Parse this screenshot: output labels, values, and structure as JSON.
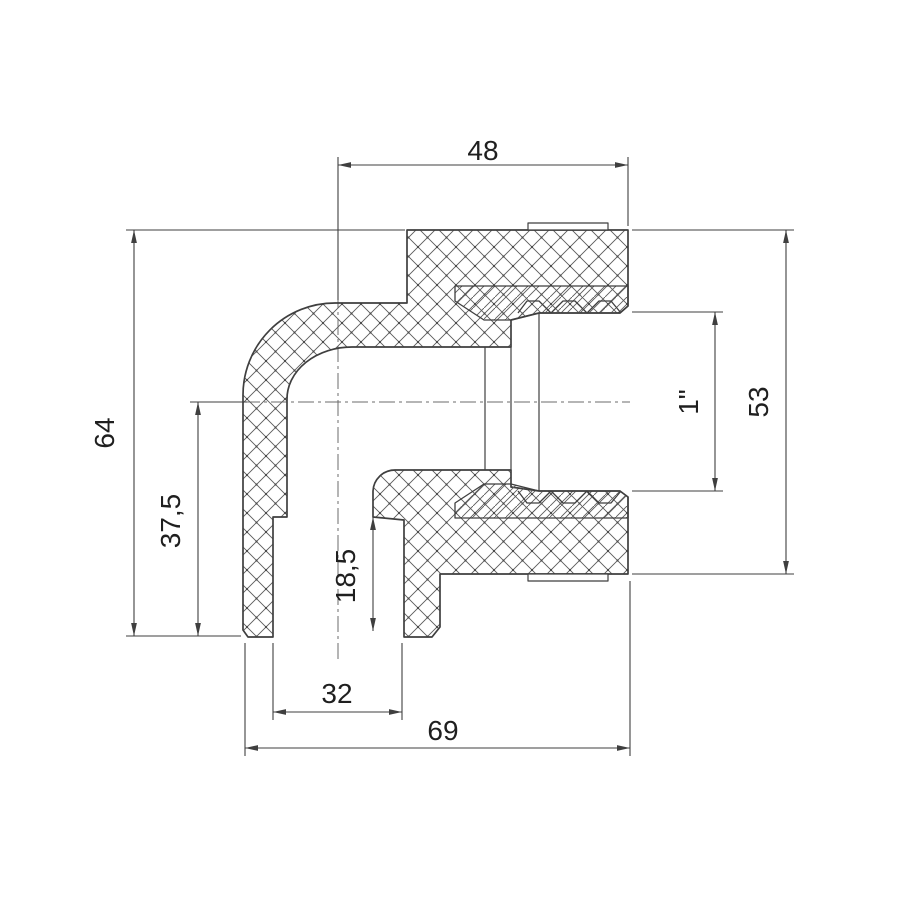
{
  "drawing": {
    "dimensions": {
      "top_width": "48",
      "overall_height": "64",
      "center_height": "37,5",
      "socket_depth": "18,5",
      "socket_bore": "32",
      "overall_width": "69",
      "thread_size": "1\"",
      "side_height": "53"
    },
    "colors": {
      "line": "#3f3f3f",
      "hatch": "#5a5a5a",
      "text": "#1f1f1f",
      "background": "#ffffff"
    }
  }
}
